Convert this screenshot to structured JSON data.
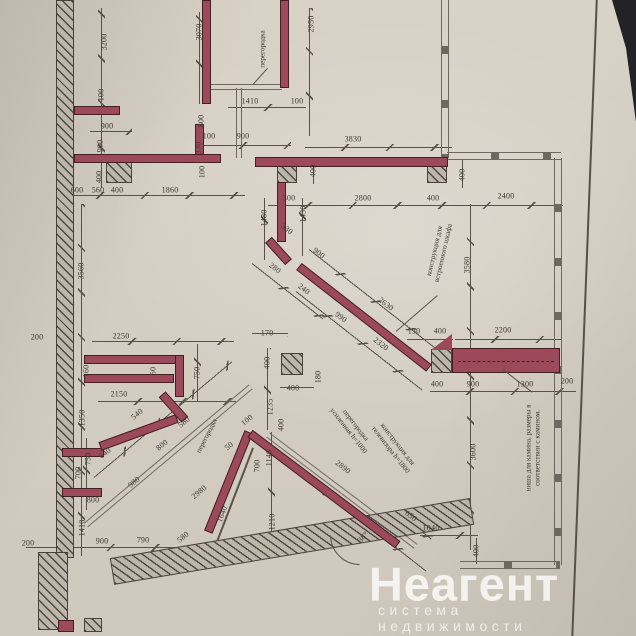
{
  "watermark": {
    "brand": "Неагент",
    "tagline": "система недвижимости"
  },
  "plan": {
    "colors": {
      "paper": "#d6d0c5",
      "wall_red": "#9c4a5a",
      "hatch_fill": "#bcb6ab",
      "line": "#57534b",
      "window_line": "#6e6960",
      "dark_corner": "#232226"
    },
    "dimensions": [
      {
        "t": "3200",
        "x": 104,
        "y": 42,
        "r": -90
      },
      {
        "t": "100",
        "x": 101,
        "y": 95,
        "r": -90
      },
      {
        "t": "900",
        "x": 107,
        "y": 126,
        "r": 0
      },
      {
        "t": "900",
        "x": 100,
        "y": 146,
        "r": -90
      },
      {
        "t": "400",
        "x": 99,
        "y": 177,
        "r": -90
      },
      {
        "t": "600",
        "x": 77,
        "y": 190,
        "r": 0
      },
      {
        "t": "560",
        "x": 98,
        "y": 190,
        "r": 0
      },
      {
        "t": "400",
        "x": 117,
        "y": 190,
        "r": 0
      },
      {
        "t": "1860",
        "x": 170,
        "y": 190,
        "r": 0
      },
      {
        "t": "3070",
        "x": 199,
        "y": 32,
        "r": -90
      },
      {
        "t": "2950",
        "x": 311,
        "y": 24,
        "r": -90
      },
      {
        "t": "1410",
        "x": 250,
        "y": 101,
        "r": 0
      },
      {
        "t": "100",
        "x": 297,
        "y": 101,
        "r": 0
      },
      {
        "t": "800",
        "x": 201,
        "y": 121,
        "r": -90
      },
      {
        "t": "100",
        "x": 209,
        "y": 136,
        "r": 0
      },
      {
        "t": "900",
        "x": 243,
        "y": 136,
        "r": 0
      },
      {
        "t": "330",
        "x": 198,
        "y": 148,
        "r": -90
      },
      {
        "t": "100",
        "x": 202,
        "y": 172,
        "r": -90
      },
      {
        "t": "3830",
        "x": 353,
        "y": 139,
        "r": 0
      },
      {
        "t": "400",
        "x": 313,
        "y": 171,
        "r": -90
      },
      {
        "t": "400",
        "x": 462,
        "y": 175,
        "r": -90
      },
      {
        "t": "300",
        "x": 289,
        "y": 198,
        "r": 0
      },
      {
        "t": "2800",
        "x": 363,
        "y": 198,
        "r": 0
      },
      {
        "t": "400",
        "x": 433,
        "y": 198,
        "r": 0
      },
      {
        "t": "2400",
        "x": 506,
        "y": 196,
        "r": 0
      },
      {
        "t": "1480",
        "x": 264,
        "y": 218,
        "r": -90
      },
      {
        "t": "1430",
        "x": 303,
        "y": 214,
        "r": -90
      },
      {
        "t": "330",
        "x": 287,
        "y": 229,
        "r": 38
      },
      {
        "t": "900",
        "x": 319,
        "y": 253,
        "r": 38
      },
      {
        "t": "280",
        "x": 275,
        "y": 268,
        "r": 38
      },
      {
        "t": "240",
        "x": 304,
        "y": 289,
        "r": 38
      },
      {
        "t": "2630",
        "x": 386,
        "y": 304,
        "r": 38
      },
      {
        "t": "990",
        "x": 341,
        "y": 317,
        "r": 38
      },
      {
        "t": "2320",
        "x": 381,
        "y": 344,
        "r": 38
      },
      {
        "t": "3560",
        "x": 81,
        "y": 271,
        "r": -90
      },
      {
        "t": "200",
        "x": 37,
        "y": 337,
        "r": 0
      },
      {
        "t": "2250",
        "x": 121,
        "y": 336,
        "r": 0
      },
      {
        "t": "170",
        "x": 267,
        "y": 333,
        "r": 0
      },
      {
        "t": "400",
        "x": 267,
        "y": 363,
        "r": -90
      },
      {
        "t": "400",
        "x": 293,
        "y": 388,
        "r": 0
      },
      {
        "t": "180",
        "x": 318,
        "y": 377,
        "r": -90
      },
      {
        "t": "1235",
        "x": 270,
        "y": 407,
        "r": -90
      },
      {
        "t": "400",
        "x": 281,
        "y": 425,
        "r": -90
      },
      {
        "t": "160",
        "x": 86,
        "y": 371,
        "r": -90
      },
      {
        "t": "50",
        "x": 153,
        "y": 371,
        "r": -90
      },
      {
        "t": "750",
        "x": 197,
        "y": 373,
        "r": -90
      },
      {
        "t": "2150",
        "x": 119,
        "y": 394,
        "r": 0
      },
      {
        "t": "1350",
        "x": 82,
        "y": 418,
        "r": -90
      },
      {
        "t": "540",
        "x": 137,
        "y": 414,
        "r": -40
      },
      {
        "t": "580",
        "x": 184,
        "y": 422,
        "r": -40
      },
      {
        "t": "800",
        "x": 162,
        "y": 445,
        "r": -40
      },
      {
        "t": "980",
        "x": 134,
        "y": 482,
        "r": -40
      },
      {
        "t": "640",
        "x": 105,
        "y": 453,
        "r": -40
      },
      {
        "t": "750",
        "x": 88,
        "y": 459,
        "r": -90
      },
      {
        "t": "700",
        "x": 78,
        "y": 473,
        "r": -90
      },
      {
        "t": "800",
        "x": 93,
        "y": 500,
        "r": 0
      },
      {
        "t": "1410",
        "x": 82,
        "y": 528,
        "r": -90
      },
      {
        "t": "200",
        "x": 28,
        "y": 543,
        "r": 0
      },
      {
        "t": "900",
        "x": 102,
        "y": 541,
        "r": 0
      },
      {
        "t": "790",
        "x": 143,
        "y": 540,
        "r": 0
      },
      {
        "t": "580",
        "x": 183,
        "y": 537,
        "r": -40
      },
      {
        "t": "2980",
        "x": 199,
        "y": 492,
        "r": -40
      },
      {
        "t": "100",
        "x": 247,
        "y": 420,
        "r": -40
      },
      {
        "t": "50",
        "x": 229,
        "y": 446,
        "r": -40
      },
      {
        "t": "700",
        "x": 257,
        "y": 466,
        "r": -90
      },
      {
        "t": "1140",
        "x": 269,
        "y": 458,
        "r": -90
      },
      {
        "t": "1210",
        "x": 272,
        "y": 522,
        "r": -90
      },
      {
        "t": "1640",
        "x": 222,
        "y": 514,
        "r": -70
      },
      {
        "t": "2890",
        "x": 343,
        "y": 467,
        "r": 38
      },
      {
        "t": "650",
        "x": 411,
        "y": 516,
        "r": 38
      },
      {
        "t": "1040",
        "x": 431,
        "y": 528,
        "r": 0
      },
      {
        "t": "400",
        "x": 476,
        "y": 551,
        "r": -90
      },
      {
        "t": "3580",
        "x": 467,
        "y": 265,
        "r": -90
      },
      {
        "t": "3600",
        "x": 473,
        "y": 452,
        "r": -90
      },
      {
        "t": "130",
        "x": 414,
        "y": 331,
        "r": 0
      },
      {
        "t": "400",
        "x": 440,
        "y": 331,
        "r": 0
      },
      {
        "t": "2200",
        "x": 503,
        "y": 330,
        "r": 0
      },
      {
        "t": "400",
        "x": 437,
        "y": 384,
        "r": 0
      },
      {
        "t": "900",
        "x": 473,
        "y": 384,
        "r": 0
      },
      {
        "t": "1300",
        "x": 525,
        "y": 384,
        "r": 0
      },
      {
        "t": "200",
        "x": 567,
        "y": 381,
        "r": 0
      },
      {
        "t": "38°",
        "x": 363,
        "y": 537,
        "r": -45
      }
    ],
    "annotations": [
      {
        "lines": [
          "перегородка"
        ],
        "x": 263,
        "y": 49,
        "r": -90
      },
      {
        "lines": [
          "перегородка"
        ],
        "x": 207,
        "y": 436,
        "r": -63
      },
      {
        "lines": [
          "перегородка",
          "усиленная h=1000"
        ],
        "x": 352,
        "y": 428,
        "r": 52
      },
      {
        "lines": [
          "конструкция для",
          "телевизора h=1800"
        ],
        "x": 394,
        "y": 447,
        "r": 52
      },
      {
        "lines": [
          "конструкция для",
          "встроенного шкафа"
        ],
        "x": 439,
        "y": 252,
        "r": -77
      },
      {
        "lines": [
          "ниша для камина, размеры в",
          "соответствии с камином."
        ],
        "x": 533,
        "y": 448,
        "r": -90
      }
    ]
  }
}
